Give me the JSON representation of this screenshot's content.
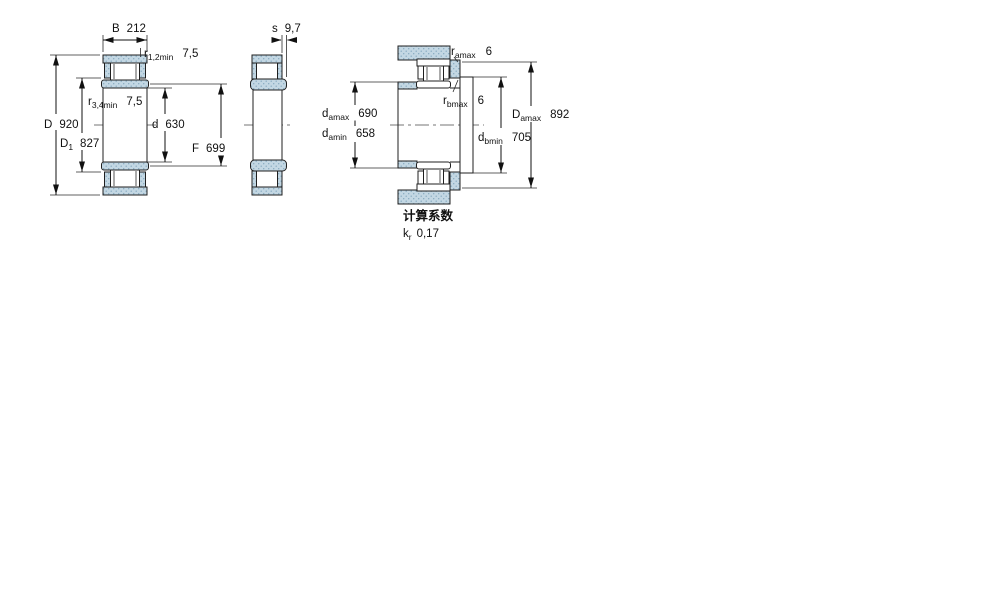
{
  "drawing": {
    "section_fill": "#c3d7e3",
    "section_dot": "#86a9bf",
    "line_color": "#1f1f1f"
  },
  "dims": {
    "B": {
      "label": "B",
      "value": "212"
    },
    "r12": {
      "label": "r",
      "sub": "1,2min",
      "value": "7,5"
    },
    "r34": {
      "label": "r",
      "sub": "3,4min",
      "value": "7,5"
    },
    "D": {
      "label": "D",
      "value": "920"
    },
    "D1": {
      "label": "D",
      "sub": "1",
      "value": "827"
    },
    "d": {
      "label": "d",
      "value": "630"
    },
    "F": {
      "label": "F",
      "value": "699"
    },
    "s": {
      "label": "s",
      "value": "9,7"
    },
    "ra": {
      "label": "r",
      "sub": "amax",
      "value": "6"
    },
    "rb": {
      "label": "r",
      "sub": "bmax",
      "value": "6"
    },
    "da_max": {
      "label": "d",
      "sub": "amax",
      "value": "690"
    },
    "da_min": {
      "label": "d",
      "sub": "amin",
      "value": "658"
    },
    "Da_max": {
      "label": "D",
      "sub": "amax",
      "value": "892"
    },
    "db_min": {
      "label": "d",
      "sub": "bmin",
      "value": "705"
    }
  },
  "factors": {
    "heading": "计算系数",
    "kr": {
      "label": "k",
      "sub": "r",
      "value": "0,17"
    }
  }
}
